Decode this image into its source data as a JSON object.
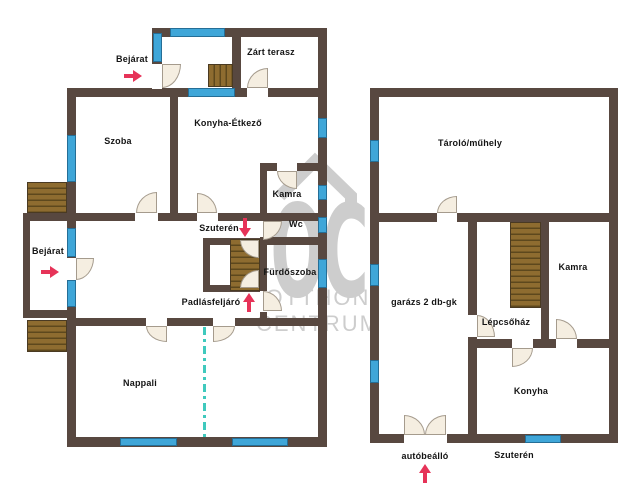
{
  "watermark": {
    "letters": "OC",
    "line1": "OTTHON",
    "line2": "CENTRUM"
  },
  "colors": {
    "wall": "#584840",
    "stair": "#8e6c30",
    "stair_line": "#5d481d",
    "window": "#3fa6d8",
    "window_edge": "#256e96",
    "door_fill": "#f5eee1",
    "door_edge": "#a59b8d",
    "arrow": "#e63358",
    "divider": "#3fc9bd",
    "label": "#141414",
    "watermark": "#cdcdcd"
  },
  "elements": {
    "walls": [
      {
        "x": 152,
        "y": 28,
        "w": 175,
        "h": 9
      },
      {
        "x": 152,
        "y": 28,
        "w": 10,
        "h": 69
      },
      {
        "x": 232,
        "y": 37,
        "w": 9,
        "h": 51
      },
      {
        "x": 67,
        "y": 88,
        "w": 260,
        "h": 9
      },
      {
        "x": 67,
        "y": 88,
        "w": 9,
        "h": 359
      },
      {
        "x": 318,
        "y": 28,
        "w": 9,
        "h": 419
      },
      {
        "x": 67,
        "y": 437,
        "w": 260,
        "h": 10
      },
      {
        "x": 170,
        "y": 97,
        "w": 8,
        "h": 124
      },
      {
        "x": 67,
        "y": 213,
        "w": 260,
        "h": 8
      },
      {
        "x": 67,
        "y": 318,
        "w": 260,
        "h": 8
      },
      {
        "x": 260,
        "y": 163,
        "w": 67,
        "h": 8
      },
      {
        "x": 260,
        "y": 163,
        "w": 7,
        "h": 58
      },
      {
        "x": 260,
        "y": 237,
        "w": 67,
        "h": 8
      },
      {
        "x": 260,
        "y": 237,
        "w": 7,
        "h": 81
      },
      {
        "x": 203,
        "y": 238,
        "w": 57,
        "h": 7
      },
      {
        "x": 203,
        "y": 238,
        "w": 7,
        "h": 54
      },
      {
        "x": 203,
        "y": 285,
        "w": 57,
        "h": 7
      },
      {
        "x": 23,
        "y": 213,
        "w": 44,
        "h": 8
      },
      {
        "x": 23,
        "y": 213,
        "w": 7,
        "h": 105
      },
      {
        "x": 23,
        "y": 310,
        "w": 44,
        "h": 8
      },
      {
        "x": 370,
        "y": 88,
        "w": 248,
        "h": 9
      },
      {
        "x": 370,
        "y": 88,
        "w": 9,
        "h": 355
      },
      {
        "x": 609,
        "y": 88,
        "w": 9,
        "h": 355
      },
      {
        "x": 370,
        "y": 434,
        "w": 248,
        "h": 9
      },
      {
        "x": 370,
        "y": 213,
        "w": 248,
        "h": 9
      },
      {
        "x": 468,
        "y": 213,
        "w": 9,
        "h": 230
      },
      {
        "x": 541,
        "y": 213,
        "w": 8,
        "h": 135
      },
      {
        "x": 477,
        "y": 339,
        "w": 141,
        "h": 9
      }
    ],
    "wall_gaps": [
      {
        "x": 152,
        "y": 64,
        "w": 10,
        "h": 25
      },
      {
        "x": 247,
        "y": 88,
        "w": 21,
        "h": 9
      },
      {
        "x": 135,
        "y": 213,
        "w": 23,
        "h": 8
      },
      {
        "x": 197,
        "y": 213,
        "w": 21,
        "h": 8
      },
      {
        "x": 277,
        "y": 163,
        "w": 20,
        "h": 8
      },
      {
        "x": 67,
        "y": 258,
        "w": 9,
        "h": 23
      },
      {
        "x": 146,
        "y": 318,
        "w": 21,
        "h": 8
      },
      {
        "x": 213,
        "y": 318,
        "w": 22,
        "h": 8
      },
      {
        "x": 260,
        "y": 291,
        "w": 7,
        "h": 21
      },
      {
        "x": 437,
        "y": 213,
        "w": 20,
        "h": 9
      },
      {
        "x": 468,
        "y": 315,
        "w": 9,
        "h": 22
      },
      {
        "x": 556,
        "y": 339,
        "w": 21,
        "h": 9
      },
      {
        "x": 512,
        "y": 339,
        "w": 21,
        "h": 9
      },
      {
        "x": 404,
        "y": 434,
        "w": 43,
        "h": 9
      }
    ],
    "stairs": [
      {
        "x": 208,
        "y": 64,
        "w": 25,
        "h": 23,
        "dir": "v"
      },
      {
        "x": 27,
        "y": 182,
        "w": 40,
        "h": 31,
        "dir": "h"
      },
      {
        "x": 27,
        "y": 320,
        "w": 40,
        "h": 32,
        "dir": "h"
      },
      {
        "x": 230,
        "y": 239,
        "w": 30,
        "h": 52,
        "dir": "h"
      },
      {
        "x": 510,
        "y": 222,
        "w": 31,
        "h": 86,
        "dir": "h"
      }
    ],
    "windows": [
      {
        "x": 170,
        "y": 28,
        "w": 55,
        "h": 9
      },
      {
        "x": 153,
        "y": 33,
        "w": 9,
        "h": 29
      },
      {
        "x": 188,
        "y": 88,
        "w": 47,
        "h": 9
      },
      {
        "x": 67,
        "y": 135,
        "w": 9,
        "h": 47
      },
      {
        "x": 67,
        "y": 228,
        "w": 9,
        "h": 29
      },
      {
        "x": 67,
        "y": 280,
        "w": 9,
        "h": 27
      },
      {
        "x": 318,
        "y": 118,
        "w": 9,
        "h": 20
      },
      {
        "x": 318,
        "y": 185,
        "w": 9,
        "h": 15
      },
      {
        "x": 318,
        "y": 217,
        "w": 9,
        "h": 16
      },
      {
        "x": 318,
        "y": 259,
        "w": 9,
        "h": 29
      },
      {
        "x": 120,
        "y": 438,
        "w": 57,
        "h": 8
      },
      {
        "x": 232,
        "y": 438,
        "w": 56,
        "h": 8
      },
      {
        "x": 370,
        "y": 140,
        "w": 9,
        "h": 22
      },
      {
        "x": 370,
        "y": 264,
        "w": 9,
        "h": 22
      },
      {
        "x": 370,
        "y": 360,
        "w": 9,
        "h": 23
      },
      {
        "x": 525,
        "y": 435,
        "w": 36,
        "h": 8
      }
    ],
    "doors": [
      {
        "x": 162,
        "y": 64,
        "w": 19,
        "h": 24,
        "round": "br"
      },
      {
        "x": 247,
        "y": 68,
        "w": 21,
        "h": 20,
        "round": "tl"
      },
      {
        "x": 277,
        "y": 171,
        "w": 20,
        "h": 18,
        "round": "bl"
      },
      {
        "x": 136,
        "y": 192,
        "w": 21,
        "h": 21,
        "round": "tl"
      },
      {
        "x": 197,
        "y": 193,
        "w": 20,
        "h": 20,
        "round": "tr"
      },
      {
        "x": 76,
        "y": 258,
        "w": 18,
        "h": 22,
        "round": "br"
      },
      {
        "x": 263,
        "y": 221,
        "w": 19,
        "h": 19,
        "round": "br"
      },
      {
        "x": 240,
        "y": 240,
        "w": 19,
        "h": 18,
        "round": "bl"
      },
      {
        "x": 240,
        "y": 270,
        "w": 19,
        "h": 18,
        "round": "tl"
      },
      {
        "x": 263,
        "y": 291,
        "w": 19,
        "h": 20,
        "round": "tr"
      },
      {
        "x": 146,
        "y": 326,
        "w": 21,
        "h": 16,
        "round": "bl"
      },
      {
        "x": 213,
        "y": 326,
        "w": 22,
        "h": 16,
        "round": "br"
      },
      {
        "x": 437,
        "y": 196,
        "w": 20,
        "h": 17,
        "round": "tl"
      },
      {
        "x": 477,
        "y": 315,
        "w": 18,
        "h": 22,
        "round": "tr"
      },
      {
        "x": 556,
        "y": 319,
        "w": 21,
        "h": 20,
        "round": "tr"
      },
      {
        "x": 512,
        "y": 348,
        "w": 21,
        "h": 19,
        "round": "br"
      },
      {
        "x": 404,
        "y": 415,
        "w": 21,
        "h": 20,
        "round": "tr"
      },
      {
        "x": 425,
        "y": 415,
        "w": 21,
        "h": 20,
        "round": "tl"
      }
    ],
    "divider": {
      "x": 203,
      "y": 327,
      "w": 3,
      "h": 110
    },
    "labels": [
      {
        "name": "label-bejarat-top",
        "text": "Bejárat",
        "cx": 132,
        "cy": 59
      },
      {
        "name": "label-zart-terasz",
        "text": "Zárt terasz",
        "cx": 271,
        "cy": 52
      },
      {
        "name": "label-szoba",
        "text": "Szoba",
        "cx": 118,
        "cy": 141
      },
      {
        "name": "label-konyha-etkezo",
        "text": "Konyha-Étkező",
        "cx": 228,
        "cy": 123
      },
      {
        "name": "label-kamra-left",
        "text": "Kamra",
        "cx": 287,
        "cy": 194
      },
      {
        "name": "label-szuteren-left",
        "text": "Szuterén",
        "cx": 219,
        "cy": 228
      },
      {
        "name": "label-wc",
        "text": "Wc",
        "cx": 296,
        "cy": 224
      },
      {
        "name": "label-furdoszoba",
        "text": "Fürdőszoba",
        "cx": 290,
        "cy": 272
      },
      {
        "name": "label-padlasfeljaro",
        "text": "Padlásfeljáró",
        "cx": 211,
        "cy": 302
      },
      {
        "name": "label-bejarat-left",
        "text": "Bejárat",
        "cx": 48,
        "cy": 251
      },
      {
        "name": "label-nappali",
        "text": "Nappali",
        "cx": 140,
        "cy": 383
      },
      {
        "name": "label-tarolo-muhely",
        "text": "Tároló/műhely",
        "cx": 470,
        "cy": 143
      },
      {
        "name": "label-garazs",
        "text": "garázs 2 db-gk",
        "cx": 424,
        "cy": 302
      },
      {
        "name": "label-kamra-right",
        "text": "Kamra",
        "cx": 573,
        "cy": 267
      },
      {
        "name": "label-lepcsohaz",
        "text": "Lépcsőház",
        "cx": 506,
        "cy": 322
      },
      {
        "name": "label-konyha",
        "text": "Konyha",
        "cx": 531,
        "cy": 391
      },
      {
        "name": "label-autobeallo",
        "text": "autóbeálló",
        "cx": 425,
        "cy": 456
      },
      {
        "name": "label-szuteren-right",
        "text": "Szuterén",
        "cx": 514,
        "cy": 455
      }
    ],
    "arrows": [
      {
        "name": "arrow-bejarat-top",
        "dir": "right",
        "x": 124,
        "y": 70
      },
      {
        "name": "arrow-bejarat-left",
        "dir": "right",
        "x": 41,
        "y": 266
      },
      {
        "name": "arrow-szuteren-down",
        "dir": "down",
        "x": 239,
        "y": 218
      },
      {
        "name": "arrow-padlasfeljaro-up",
        "dir": "up",
        "x": 243,
        "y": 293
      },
      {
        "name": "arrow-autobeallo-up",
        "dir": "up",
        "x": 419,
        "y": 464
      }
    ]
  }
}
